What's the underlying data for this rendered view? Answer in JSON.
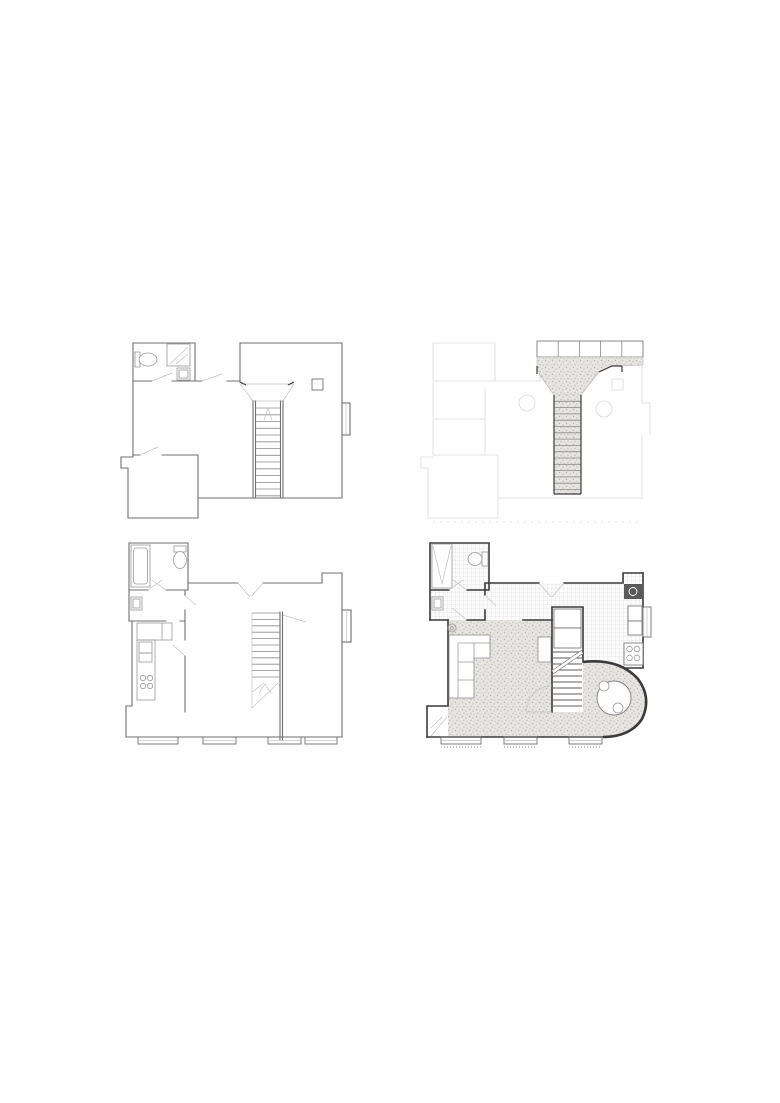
{
  "page": {
    "background": "#ffffff",
    "width": 780,
    "height": 1103
  },
  "palette": {
    "white": "#ffffff",
    "wall": "#6f6f6f",
    "wall_dark": "#3a3a3a",
    "fixture": "#9a9a9a",
    "light_line": "#c2c2c2",
    "faint_line": "#dadada",
    "stipple_bg": "#e6e5e2",
    "stipple_dot": "#b3b1ad",
    "tile_line": "#d5d5d5",
    "appliance_dark": "#5a5a5a"
  },
  "plans": [
    {
      "id": "upper-floor-existing",
      "position": "top-left",
      "style": "grey line drawing",
      "features": [
        "bathroom",
        "shower",
        "toilet",
        "wash-basin",
        "hall",
        "staircase-down",
        "splayed-landing",
        "rooflight-square",
        "window-bay",
        "rear-closet"
      ]
    },
    {
      "id": "upper-floor-proposed",
      "position": "top-right",
      "style": "faint outline with stippled new work",
      "features": [
        "skylight-row",
        "stippled-landing",
        "staircase",
        "door-leaves",
        "ceiling-circles",
        "faint-shell"
      ]
    },
    {
      "id": "ground-floor-existing",
      "position": "bottom-left",
      "style": "grey line drawing",
      "features": [
        "bathroom",
        "bathtub",
        "toilet",
        "wash-basin",
        "vestibule",
        "kitchen",
        "counter",
        "hob",
        "staircase-up",
        "winders",
        "window-bays"
      ]
    },
    {
      "id": "ground-floor-proposed",
      "position": "bottom-right",
      "style": "rendered plan with floor textures",
      "features": [
        "bathroom",
        "shower",
        "toilet",
        "wash-basin",
        "tiled-hall",
        "tiled-kitchen",
        "fridge",
        "counters",
        "hob",
        "stair-cupboards",
        "staircase",
        "living-room",
        "sofa",
        "plant",
        "side-table",
        "curved-wall",
        "round-dining-table",
        "chairs",
        "window-bays"
      ]
    }
  ]
}
